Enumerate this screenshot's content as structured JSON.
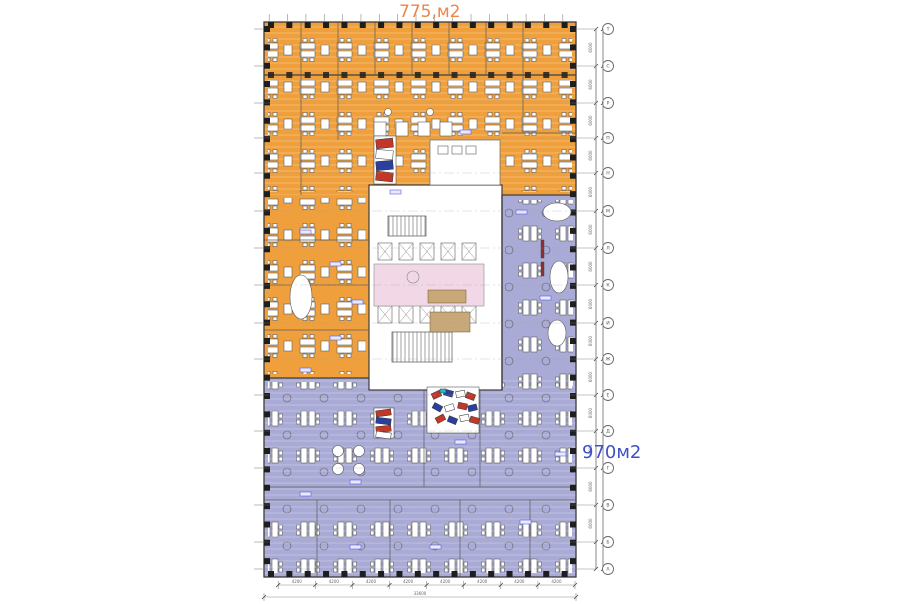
{
  "areas": {
    "orange": {
      "label": "775,м2",
      "color": "#EFA03D",
      "label_color": "#EF8547"
    },
    "purple": {
      "label": "970м2",
      "color": "#A9ABD6",
      "label_color": "#3F51C5"
    }
  },
  "core": {
    "lobby_color": "#F2D8E6"
  },
  "grid": {
    "bubble_x": 608,
    "rows": [
      {
        "label": "Т",
        "y": 29
      },
      {
        "label": "С",
        "y": 66
      },
      {
        "label": "Р",
        "y": 103
      },
      {
        "label": "П",
        "y": 138
      },
      {
        "label": "Н",
        "y": 173
      },
      {
        "label": "М",
        "y": 211
      },
      {
        "label": "Л",
        "y": 248
      },
      {
        "label": "К",
        "y": 285
      },
      {
        "label": "И",
        "y": 323
      },
      {
        "label": "Ж",
        "y": 359
      },
      {
        "label": "Е",
        "y": 395
      },
      {
        "label": "Д",
        "y": 431
      },
      {
        "label": "Г",
        "y": 468
      },
      {
        "label": "В",
        "y": 505
      },
      {
        "label": "Б",
        "y": 542
      },
      {
        "label": "А",
        "y": 569
      }
    ]
  },
  "dims": {
    "side_segment": "6000",
    "bottom_segments": [
      "4200",
      "4200",
      "4200",
      "4200",
      "4200",
      "4200",
      "4200",
      "4200"
    ],
    "bottom_total": "33600"
  }
}
